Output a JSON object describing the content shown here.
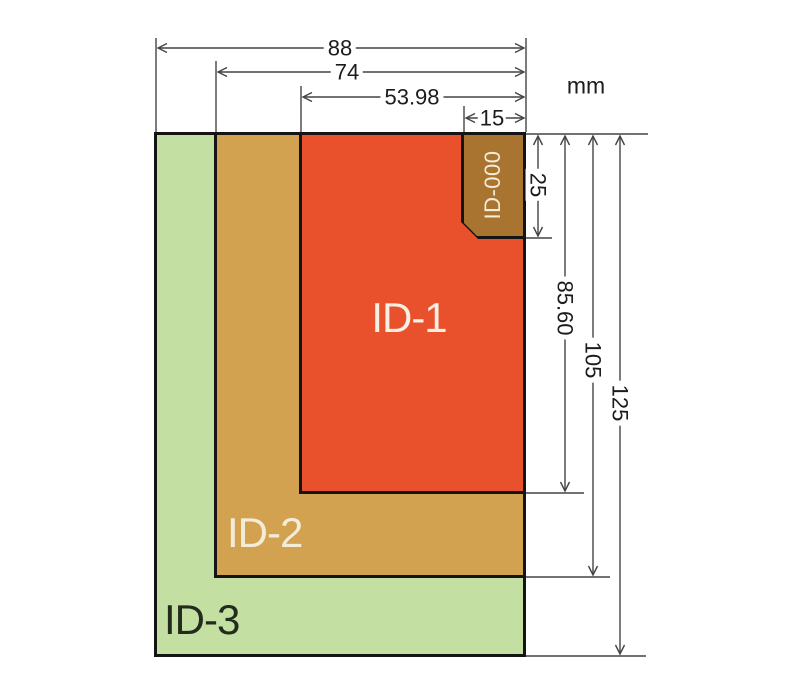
{
  "unit_label": "mm",
  "cards": [
    {
      "name": "ID-3",
      "width_mm": "88",
      "height_mm": "125",
      "fill": "#c3e0a2",
      "label_color": "#232c1c"
    },
    {
      "name": "ID-2",
      "width_mm": "74",
      "height_mm": "105",
      "fill": "#d2a250",
      "label_color": "#f3ecd9"
    },
    {
      "name": "ID-1",
      "width_mm": "53.98",
      "height_mm": "85.60",
      "fill": "#e8512b",
      "label_color": "#f6f0e3"
    },
    {
      "name": "ID-000",
      "width_mm": "15",
      "height_mm": "25",
      "fill": "#a9742f",
      "label_color": "#f3ecd9"
    }
  ],
  "dimensions": {
    "horizontal": [
      {
        "label": "88"
      },
      {
        "label": "74"
      },
      {
        "label": "53.98"
      },
      {
        "label": "15"
      }
    ],
    "vertical": [
      {
        "label": "25"
      },
      {
        "label": "85.60"
      },
      {
        "label": "105"
      },
      {
        "label": "125"
      }
    ]
  },
  "colors": {
    "outline": "#141414",
    "dimension_line": "#444444"
  }
}
